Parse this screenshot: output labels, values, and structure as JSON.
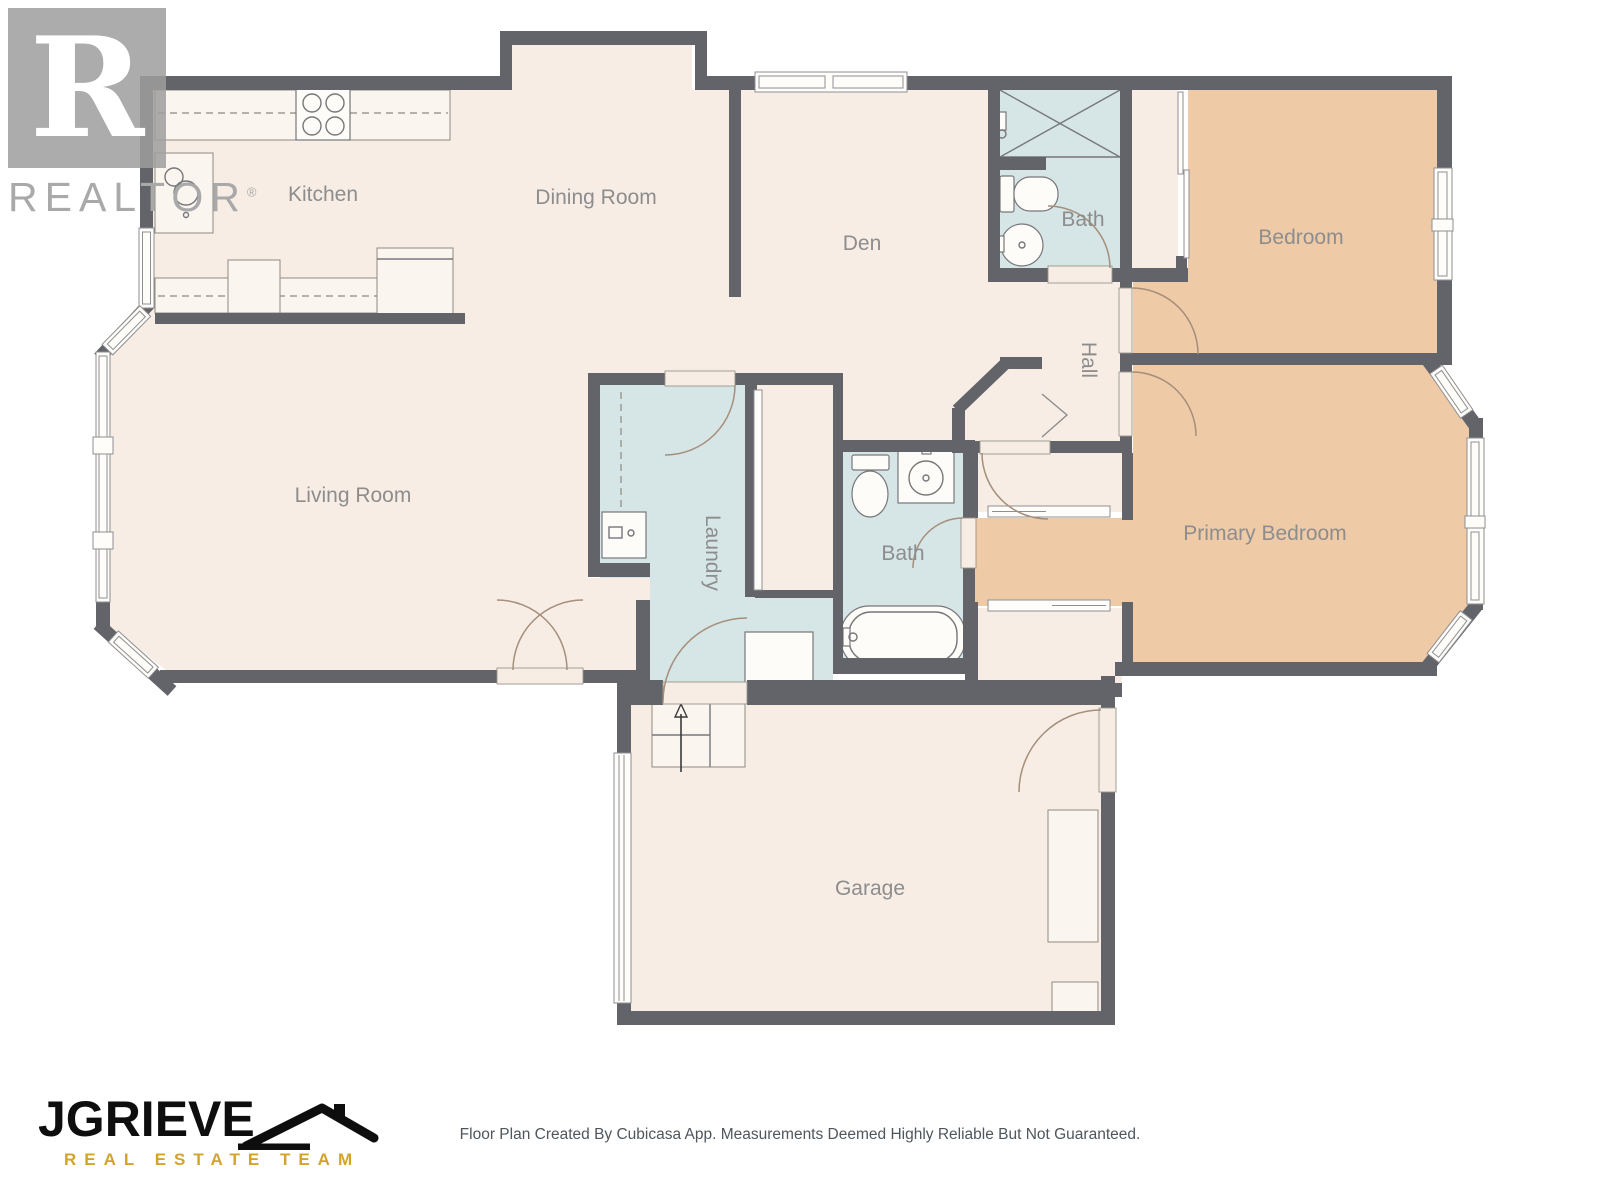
{
  "branding": {
    "realtor_logo": {
      "letter": "R",
      "wordmark": "REALTOR",
      "registered": "®"
    },
    "team_logo": {
      "name": "JGRIEVE",
      "tagline": "REAL ESTATE TEAM"
    }
  },
  "rooms": {
    "kitchen": {
      "label": "Kitchen"
    },
    "dining_room": {
      "label": "Dining Room"
    },
    "den": {
      "label": "Den"
    },
    "bath_upper": {
      "label": "Bath"
    },
    "bedroom": {
      "label": "Bedroom"
    },
    "hall": {
      "label": "Hall"
    },
    "living_room": {
      "label": "Living Room"
    },
    "laundry": {
      "label": "Laundry"
    },
    "bath_main": {
      "label": "Bath"
    },
    "primary_bedroom": {
      "label": "Primary Bedroom"
    },
    "garage": {
      "label": "Garage"
    }
  },
  "footer": {
    "disclaimer": "Floor Plan Created By Cubicasa App. Measurements Deemed Highly Reliable But Not Guaranteed."
  },
  "colors": {
    "wall": "#63646a",
    "floor": "#f7ede5",
    "wet": "#d6e5e6",
    "bed": "#eecaa7",
    "gold": "#d4a32b",
    "label": "#8d8d8d"
  }
}
